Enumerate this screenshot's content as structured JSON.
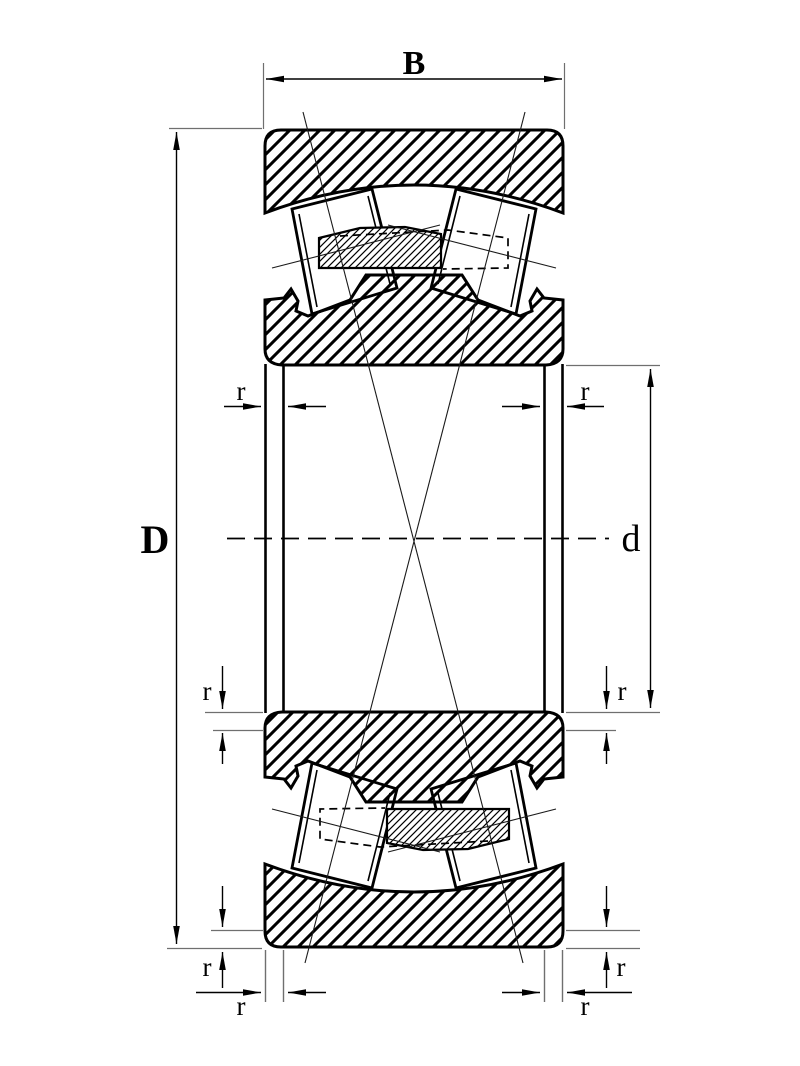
{
  "drawing": {
    "description": "spherical roller bearing cross-section drawing",
    "dimensions": {
      "width_label": "B",
      "outer_diameter_label": "D",
      "bore_diameter_label": "d",
      "chamfer_label": "r"
    },
    "colors": {
      "line": "#000000",
      "thin_line": "#6f6f6f",
      "background": "#ffffff"
    }
  }
}
